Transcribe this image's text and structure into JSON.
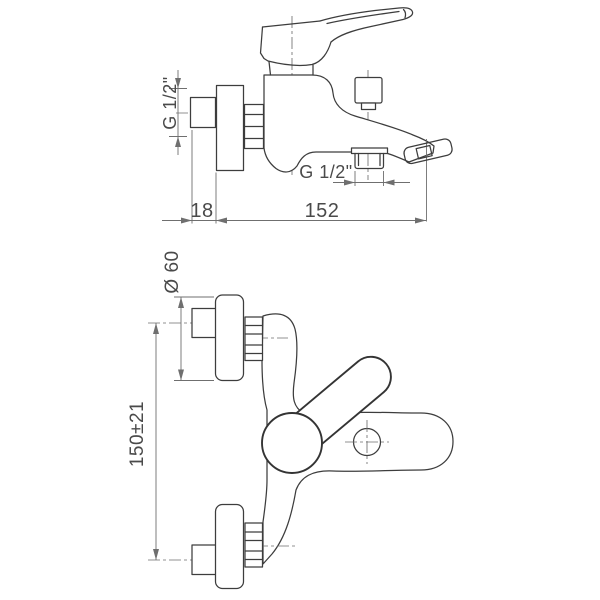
{
  "drawing": {
    "title": "Wall-mounted bath mixer technical drawing",
    "background": "#ffffff",
    "line_color": "#3d3d3d",
    "dimension_color": "#6f6f6f",
    "text_color": "#4a4a4a",
    "views": {
      "side_view": {
        "name": "side view",
        "labels": {
          "inlet_thread": "G 1/2\"",
          "eccentric_offset": "18",
          "spout_reach": "152",
          "shower_outlet_thread": "G 1/2\""
        }
      },
      "front_view": {
        "name": "front view",
        "labels": {
          "escutcheon_diameter": "Ø 60",
          "inlet_centres_distance": "150±21"
        }
      }
    }
  }
}
